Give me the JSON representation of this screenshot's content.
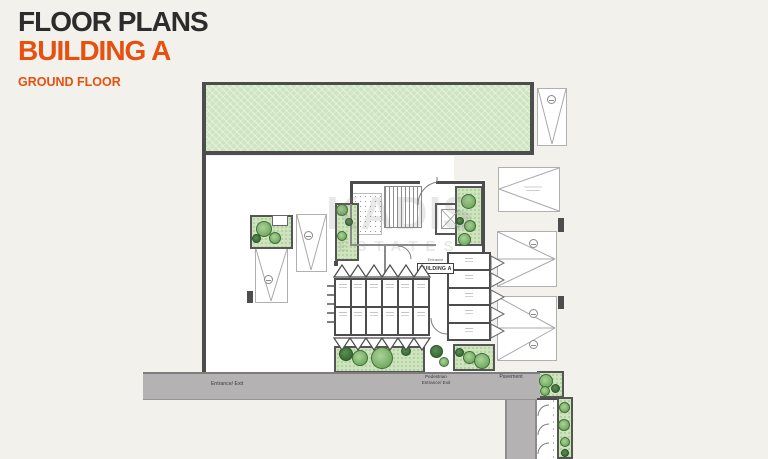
{
  "title": {
    "line1": "FLOOR PLANS",
    "line2": "BUILDING A",
    "floor": "GROUND FLOOR"
  },
  "watermark": {
    "line1": "KADIS",
    "line2": "ESTATES"
  },
  "plan": {
    "building_label": "BUILDING A",
    "entrance_label": "Entrance",
    "labels": {
      "entrance_exit": "Entrance/ Exit",
      "pedestrian_entrance": "Pedestrian\nEntrance/ Exit",
      "pavement": "Pavement"
    }
  },
  "colors": {
    "accent_orange": "#e8500f",
    "heading_dark": "#2d2b2c",
    "wall_dark": "#4d4d4d",
    "garden_green": "#cfe5c1",
    "planter_green": "#cde4bc",
    "road_gray": "#b5b2b3",
    "background": "#f2f1ec"
  }
}
